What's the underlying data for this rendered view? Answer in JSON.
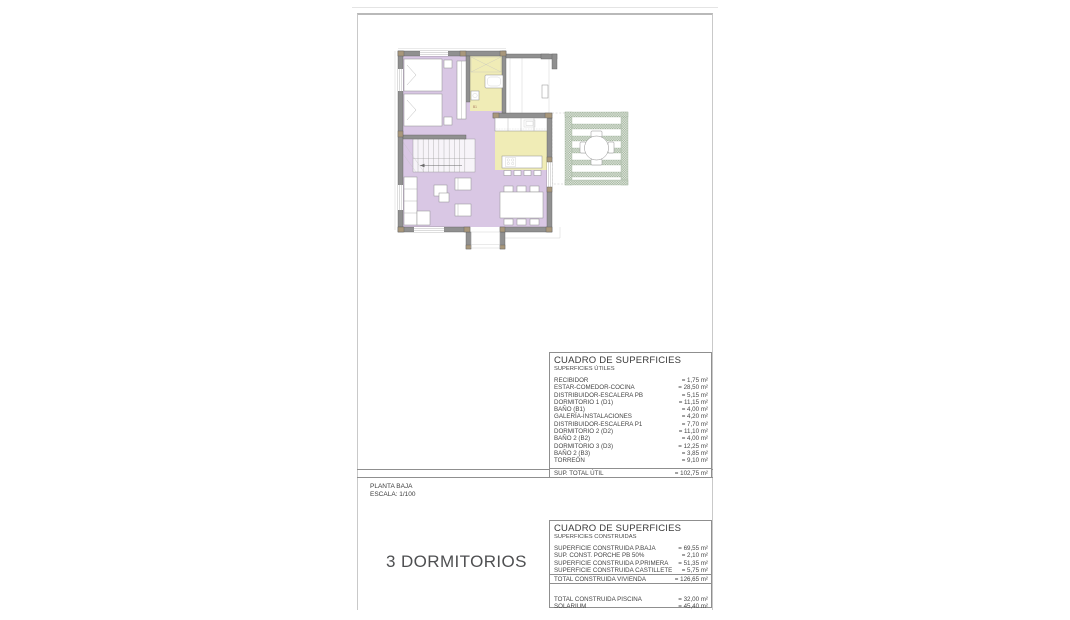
{
  "sheet": {
    "plan_name": "PLANTA BAJA",
    "scale": "ESCALA: 1/100",
    "bedrooms_caption": "3 DORMITORIOS"
  },
  "tables": {
    "utiles": {
      "title": "CUADRO DE SUPERFICIES",
      "subtitle": "SUPERFICIES ÚTILES",
      "rows": [
        {
          "label": "RECIBIDOR",
          "value": "= 1,75 m²"
        },
        {
          "label": "ESTAR-COMEDOR-COCINA",
          "value": "= 28,50 m²"
        },
        {
          "label": "DISTRIBUIDOR-ESCALERA PB",
          "value": "= 5,15 m²"
        },
        {
          "label": "DORMITORIO 1 (D1)",
          "value": "= 11,15 m²"
        },
        {
          "label": "BAÑO (B1)",
          "value": "= 4,00 m²"
        },
        {
          "label": "GALERÍA-INSTALACIONES",
          "value": "= 4,20 m²"
        },
        {
          "label": "DISTRIBUIDOR-ESCALERA P1",
          "value": "= 7,70 m²"
        },
        {
          "label": "DORMITORIO 2 (D2)",
          "value": "= 11,10 m²"
        },
        {
          "label": "BAÑO 2 (B2)",
          "value": "= 4,00 m²"
        },
        {
          "label": "DORMITORIO 3 (D3)",
          "value": "= 12,25 m²"
        },
        {
          "label": "BAÑO 2 (B3)",
          "value": "= 3,85 m²"
        },
        {
          "label": "TORREÓN",
          "value": "= 9,10 m²"
        }
      ],
      "total_label": "SUP. TOTAL ÚTIL",
      "total_value": "= 102,75 m²"
    },
    "construidas": {
      "title": "CUADRO DE SUPERFICIES",
      "subtitle": "SUPERFICIES CONSTRUIDAS",
      "rows": [
        {
          "label": "SUPERFICIE CONSTRUIDA P.BAJA",
          "value": "= 69,55 m²"
        },
        {
          "label": "SUP. CONST. PORCHE PB 50%",
          "value": "= 2,10 m²"
        },
        {
          "label": "SUPERFICIE CONSTRUIDA P.PRIMERA",
          "value": "= 51,35 m²"
        },
        {
          "label": "SUPERFICIE CONSTRUIDA CASTILLETE",
          "value": "= 5,75 m²"
        }
      ],
      "total_label": "TOTAL CONSTRUIDA VIVIENDA",
      "total_value": "= 126,65 m²",
      "extra_rows": [
        {
          "label": "TOTAL CONSTRUIDA PISCINA",
          "value": "= 32,00 m²"
        },
        {
          "label": "SOLARIUM",
          "value": "= 45,40 m²"
        }
      ]
    }
  },
  "plan": {
    "labels": {
      "bath": "B1",
      "stair": "21"
    },
    "colors": {
      "floor_main": "#d9c7e4",
      "floor_wet": "#f0ecb6",
      "pergola": "#9fb29b",
      "wall": "#909090",
      "pillar": "#a8977b"
    }
  }
}
